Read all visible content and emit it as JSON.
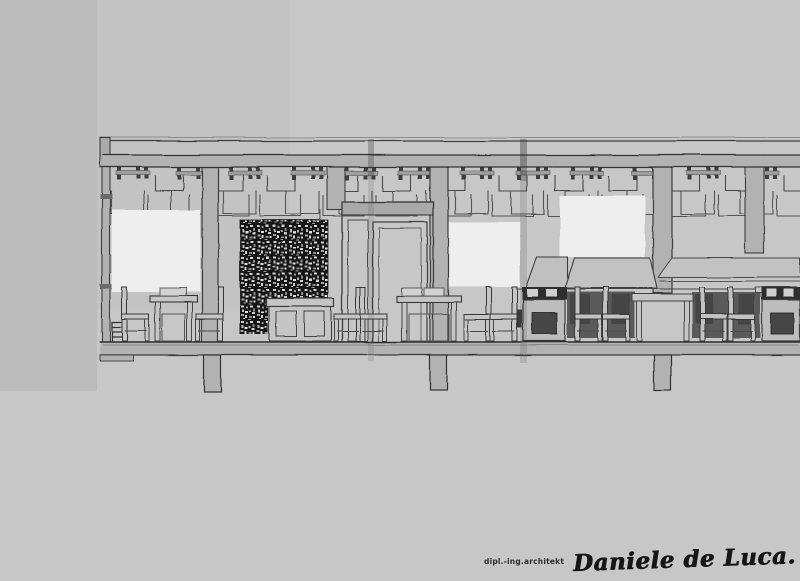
{
  "signature": {
    "credential": "dipl.-ing.architekt",
    "name": "Daniele de Luca."
  },
  "colors": {
    "canvas": "#c7c7c7",
    "left_strip": "#bbbbbb",
    "ink": "#3c3c3c",
    "structure": "#b2b2b2",
    "paper_fill": "#c5c5c5",
    "white_panel": "#eeeeee",
    "mosaic_dark": "#161616",
    "counter_shade": "#5a5a5a",
    "signature_ink": "#161616"
  }
}
